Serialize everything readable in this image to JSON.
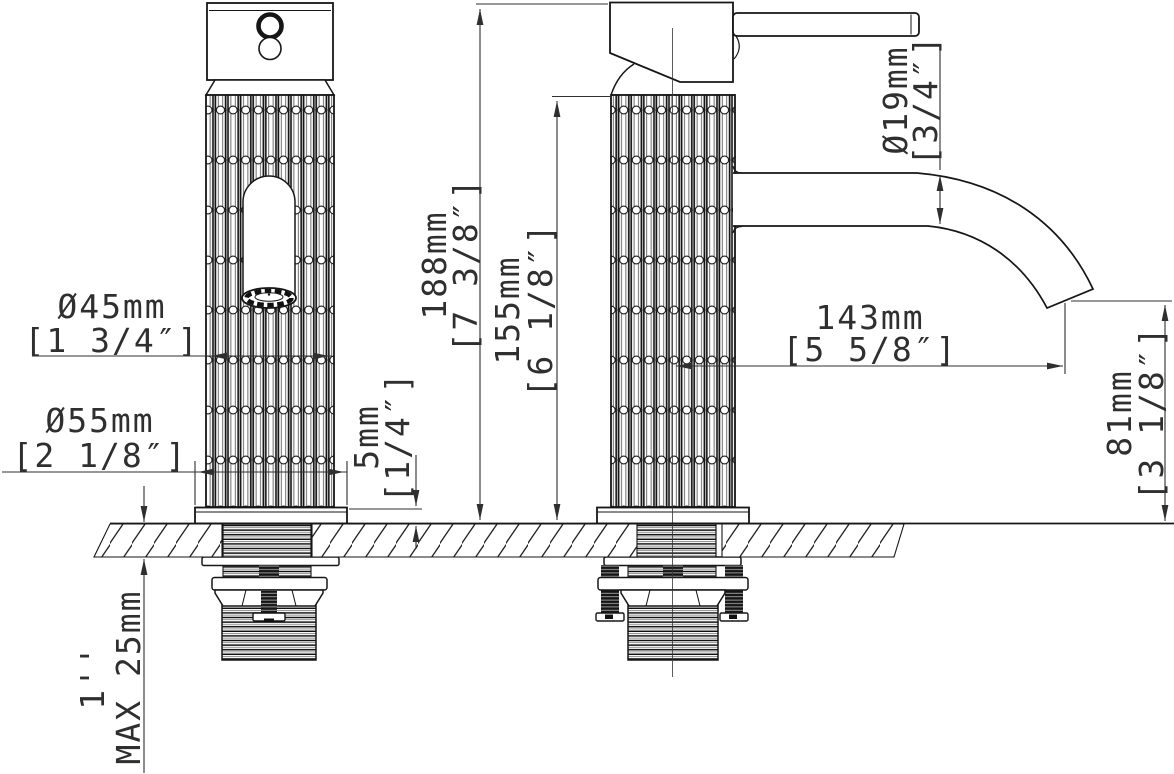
{
  "drawing": {
    "background": "#ffffff",
    "line_color": "#161616",
    "dim_color": "#2f2f2f",
    "dimensions": {
      "body_diameter": {
        "mm": "Ø45mm",
        "inch": "[1 3/4″]"
      },
      "base_diameter": {
        "mm": "Ø55mm",
        "inch": "[2 1/8″]"
      },
      "base_plate_height": {
        "mm": "5mm",
        "inch": "[1/4″]"
      },
      "overall_height": {
        "mm": "188mm",
        "inch": "[7 3/8″]"
      },
      "body_height": {
        "mm": "155mm",
        "inch": "[6 1/8″]"
      },
      "spout_tube_diameter": {
        "mm": "Ø19mm",
        "inch": "[3/4″]"
      },
      "spout_reach": {
        "mm": "143mm",
        "inch": "[5 5/8″]"
      },
      "spout_outlet_height": {
        "mm": "81mm",
        "inch": "[3 1/8″]"
      },
      "max_deck_thickness": {
        "mm": "MAX 25mm",
        "inch": "1''"
      }
    }
  }
}
